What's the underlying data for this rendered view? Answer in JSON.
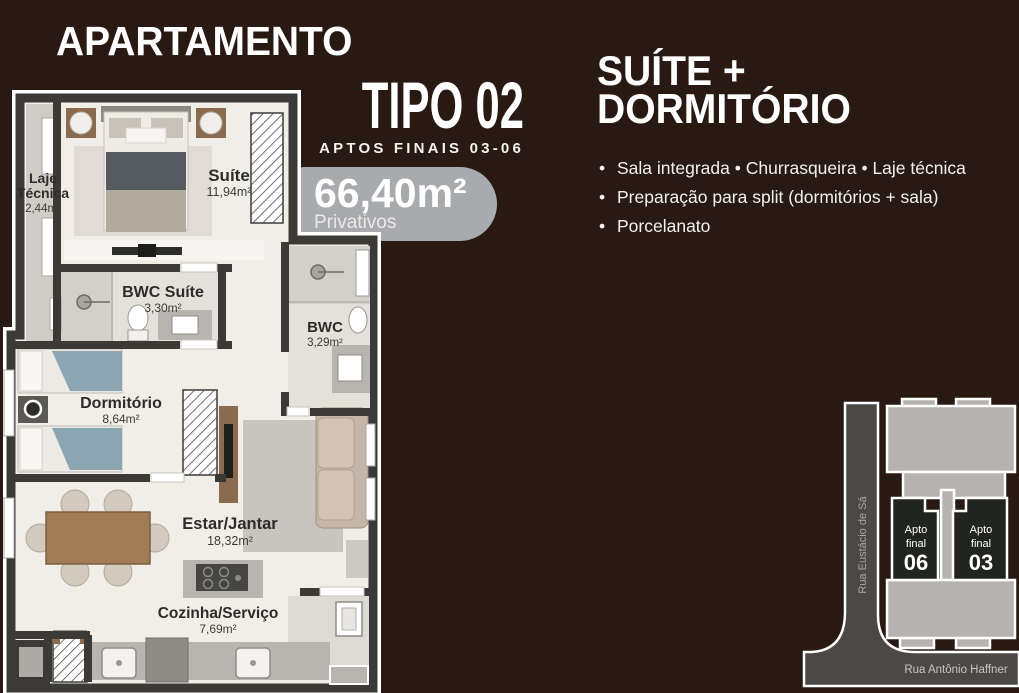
{
  "header": {
    "title": "APARTAMENTO",
    "type": "TIPO 02",
    "subtitle": "APTOS FINAIS 03-06"
  },
  "area_badge": {
    "value": "66,40m²",
    "label": "Privativos"
  },
  "highlight": {
    "line1": "SUÍTE +",
    "line2": "DORMITÓRIO"
  },
  "features": {
    "bullets": [
      "Sala integrada  •  Churrasqueira  •  Laje técnica",
      "Preparação para split (dormitórios + sala)",
      "Porcelanato"
    ]
  },
  "plan": {
    "rooms": {
      "laje_tecnica": {
        "name1": "Laje",
        "name2": "Técnica",
        "area": "2,44m²"
      },
      "suite": {
        "name": "Suíte",
        "area": "11,94m²"
      },
      "bwc_suite": {
        "name": "BWC Suíte",
        "area": "3,30m²"
      },
      "bwc": {
        "name": "BWC",
        "area": "3,29m²"
      },
      "dormitorio": {
        "name": "Dormitório",
        "area": "8,64m²"
      },
      "estar_jantar": {
        "name": "Estar/Jantar",
        "area": "18,32m²"
      },
      "cozinha": {
        "name": "Cozinha/Serviço",
        "area": "7,69m²"
      }
    }
  },
  "site_map": {
    "street_vertical": "Rua Eustácio de Sá",
    "street_horizontal": "Rua Antônio Haffner",
    "units": [
      {
        "line1": "Apto",
        "line2": "final",
        "number": "06"
      },
      {
        "line1": "Apto",
        "line2": "final",
        "number": "03"
      }
    ]
  },
  "colors": {
    "background": "#281a12",
    "badge": "#a8aaad",
    "heading_text": "#ffffff",
    "plan_floor": "#f1eee8",
    "plan_wall": "#3b3a37",
    "street": "#4b4846",
    "building_light": "#b5b2b0",
    "unit_dark": "#22251f"
  }
}
